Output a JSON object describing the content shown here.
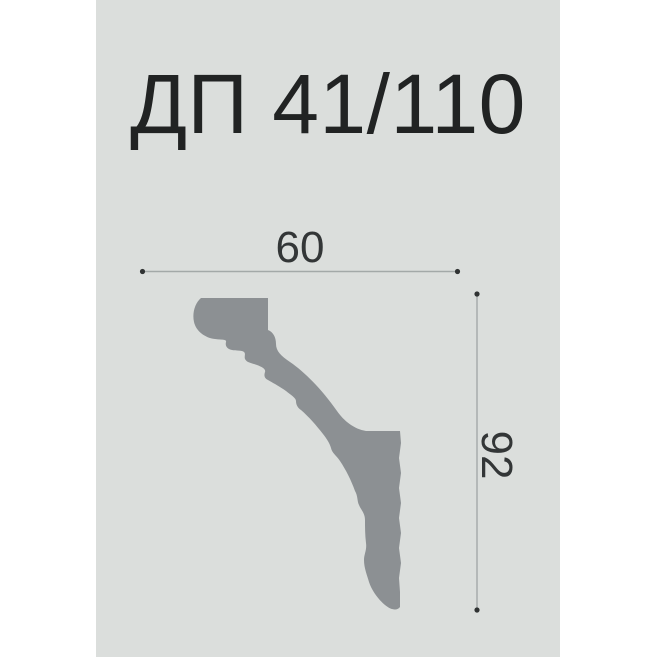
{
  "title": "ДП 41/110",
  "diagram": {
    "description": "molding profile cross-section",
    "width_label": "60",
    "height_label": "92",
    "profile_path": "M201,298 H268 V330 C273,332 276,337 276,344 C276,351 281,356 290,362 C306,373 323,391 337,411 C344,421 354,429 366,431 L400,431 L401,443 L399,458 L401,473 L399,488 L401,503 L399,518 L401,533 L399,548 L401,563 L399,578 L400,592 L400,607 C397,611 391,610 385,605 C378,599 372,591 369,582 C367,575 364,568 364,560 C364,554 367,550 366,543 C365,535 365,527 365,520 C365,513 361,510 359,505 C357,501 358,496 355,491 C351,480 346,470 340,461 C336,455 332,453 331,448 C330,444 327,439 323,434 C316,425 309,417 301,410 C298,408 296,405 296,401 C296,398 291,395 286,391 C279,386 273,383 268,380 C264,378 264,375 265,372 C266,369 262,367 257,365 C252,363 247,363 245,359 C244,356 246,354 244,352 C242,350 236,351 232,350 C227,349 225,346 226,342 C227,339 221,340 215,339 C205,338 196,331 194,322 C192,313 195,303 201,298 Z"
  },
  "colors": {
    "page_background": "#ffffff",
    "panel_background": "#dbdedc",
    "profile_fill": "#8c9093",
    "dimension_line": "#a3a9a8",
    "dimension_dot": "#303333",
    "text": "#212323"
  }
}
